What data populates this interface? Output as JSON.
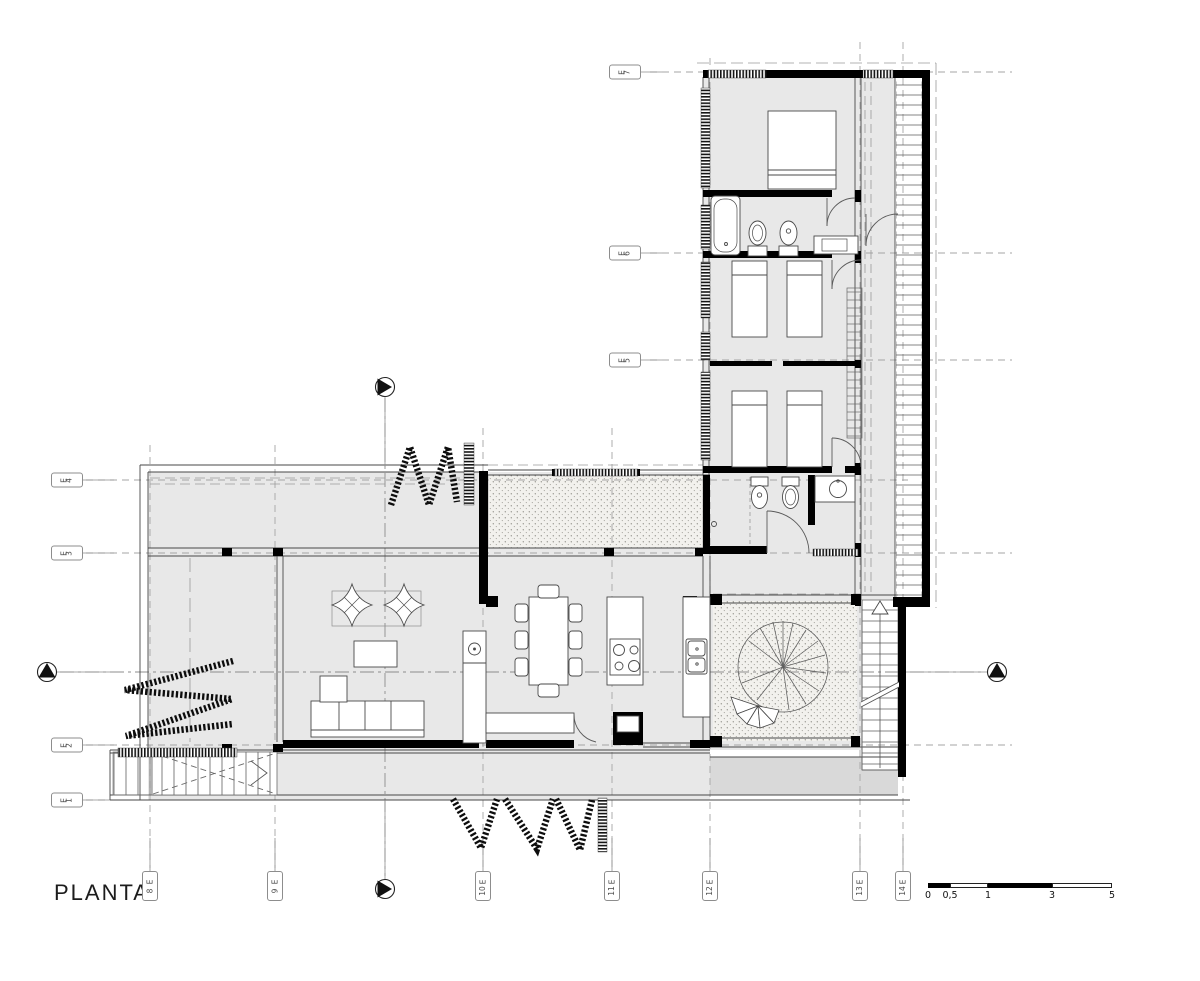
{
  "title": "PLANTA",
  "grid": {
    "left": [
      "E4",
      "E3",
      "E2",
      "E1"
    ],
    "wing": [
      "E7",
      "E6",
      "E5"
    ],
    "bottom": [
      "E8",
      "E9",
      "E10",
      "E11",
      "E12",
      "E13",
      "E14"
    ]
  },
  "scale_bar": {
    "ticks": [
      "0",
      "0,5",
      "1",
      "3",
      "5"
    ]
  },
  "symbols": {
    "section_markers": "circle-with-filled-triangle",
    "north_wing_screen": "louver-rungs",
    "courtyard_texture": "stipple-gravel",
    "folding_doors": "hatched-zigzag",
    "tree": "radial-line-circle",
    "stairs": [
      "straight-stair-with-arrow",
      "spiral-stair",
      "crossed-ramp"
    ]
  },
  "colors": {
    "floor": "#e8e8e8",
    "deck": "#d9d9d9",
    "stipple_bg": "#f2f1ed",
    "wall": "#000000",
    "grid_line": "#a5a5a5",
    "thin_line": "#444444"
  }
}
